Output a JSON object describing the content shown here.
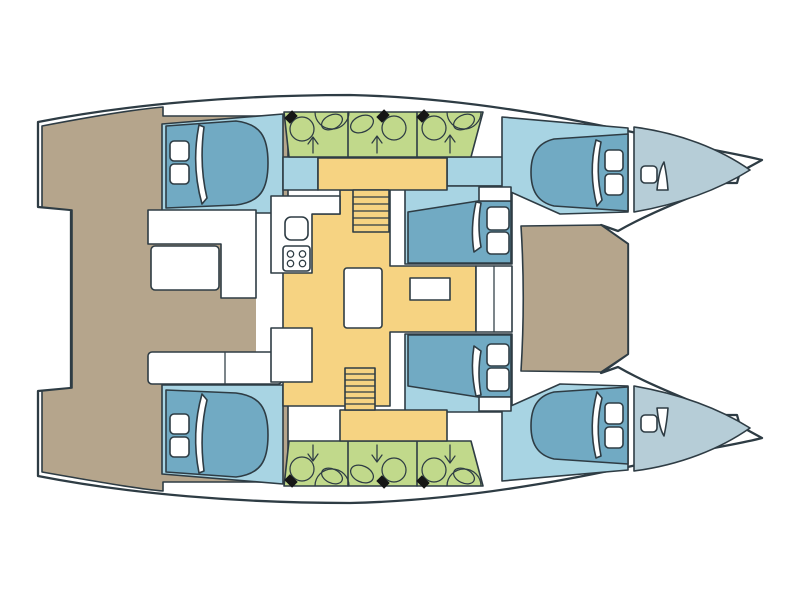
{
  "meta": {
    "type": "floor-plan",
    "subject": "catamaran-yacht-deck-layout",
    "view": "top-down",
    "orientation": "bow-right",
    "visible_text": ""
  },
  "colors": {
    "paper": "#ffffff",
    "line": "#2e3c44",
    "deck": "#b5a58c",
    "salon": "#f6d382",
    "cabin_floor": "#a8d4e3",
    "bed": "#71aac3",
    "bow_locker": "#b6cdd7",
    "bathroom": "#c1d98b",
    "white": "#ffffff",
    "black": "#161616"
  },
  "vessel": {
    "hulls": [
      "port-hull-top",
      "starboard-hull-bottom"
    ],
    "cabins": [
      "aft-cabin-port",
      "forward-cabin-port",
      "bow-cabin-port",
      "aft-cabin-starboard",
      "forward-cabin-starboard",
      "bow-cabin-starboard"
    ],
    "wet-room-compartments": 6,
    "salon": [
      "galley-counter",
      "galley-sink",
      "galley-stove",
      "salon-table",
      "seat-island",
      "companionway-stairs-port",
      "companionway-stairs-starboard"
    ],
    "cockpit": [
      "l-shaped-sofa",
      "cockpit-table",
      "aft-bench",
      "nav-seat"
    ],
    "foredeck": [
      "deck-platform"
    ],
    "bow": [
      "anchor-locker-port",
      "anchor-locker-starboard",
      "deck-hatch",
      "sail-locker-flap"
    ]
  },
  "icons": {
    "toilet": "circle with black seat-hinge diamond",
    "sink": "tilted oval in semicircle vanity",
    "shower-arrow": "drain arrow pointing outboard",
    "stove": "four burner circles",
    "pillow": "rounded white square",
    "duvet-fold": "curved white sliver on mattress",
    "hatch": "rounded white square",
    "stair-treads": "parallel lines"
  }
}
